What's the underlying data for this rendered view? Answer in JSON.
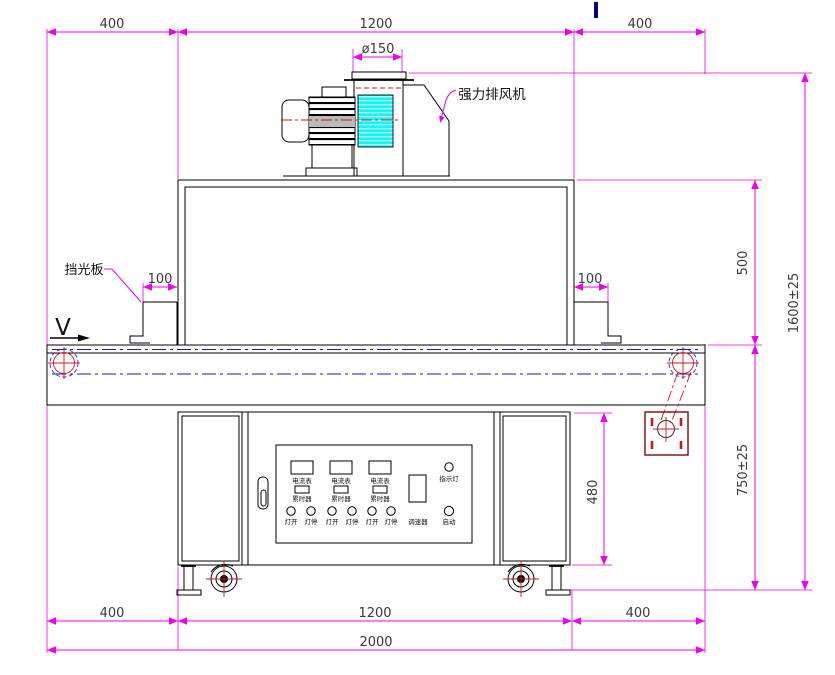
{
  "drawing": {
    "type": "engineering-drawing",
    "subject": "UV curing conveyor machine front elevation"
  },
  "labels": {
    "fan": "强力排风机",
    "shield": "挡光板",
    "direction": "V"
  },
  "dimensions": {
    "top_left": "400",
    "top_center": "1200",
    "top_right": "400",
    "duct_diameter": "ø150",
    "shield_left": "100",
    "shield_right": "100",
    "tunnel_height": "500",
    "total_height": "1600±25",
    "cabinet_height": "480",
    "belt_height": "750±25",
    "bottom_left": "400",
    "bottom_center": "1200",
    "bottom_right": "400",
    "total_width": "2000"
  },
  "control_panel": {
    "meters": [
      "电流表",
      "电流表",
      "电流表"
    ],
    "timers": [
      "累时器",
      "累时器",
      "累时器"
    ],
    "lamp_buttons": [
      "灯开",
      "灯停",
      "灯开",
      "灯停",
      "灯开",
      "灯停"
    ],
    "speed_controller": "调速器",
    "indicator_light": "指示灯",
    "start_button": "启动"
  },
  "colors": {
    "dimension_lines": "#ee00ee",
    "outline": "#000000",
    "belt_centerline": "#1a1ab0",
    "machine_centerline": "#c41c1c",
    "fan_coupling_fill": "#00ffff",
    "top_tick": "#00008b"
  }
}
